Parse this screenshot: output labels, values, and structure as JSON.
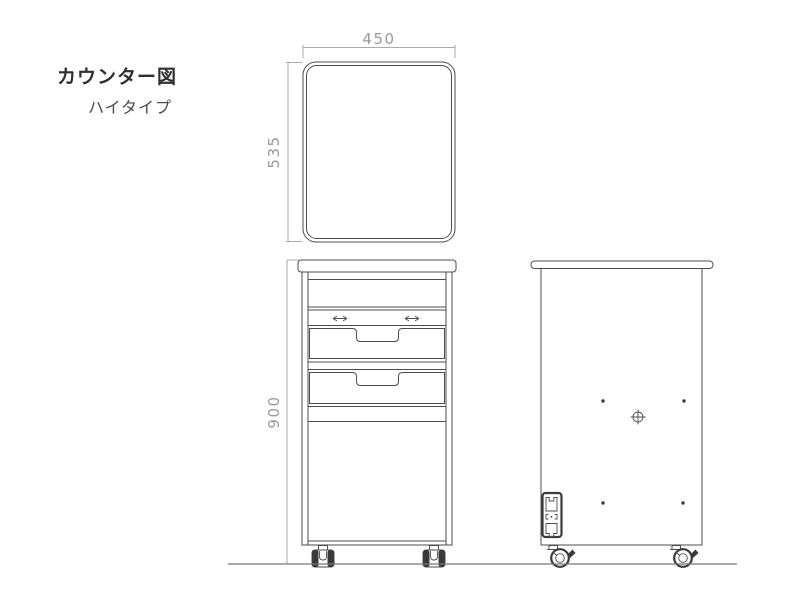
{
  "title": {
    "main": "カウンター図",
    "subtitle": "ハイタイプ"
  },
  "drawing": {
    "dimensions": {
      "top_width": "450",
      "top_depth": "535",
      "height": "900"
    },
    "views": {
      "top_view": "counter-top-plan",
      "front_view": "counter-front-elevation",
      "side_view": "counter-side-elevation"
    }
  },
  "colors": {
    "line": "#4d4d4d",
    "dark": "#3a3a3a",
    "dim": "#ababab",
    "dimtext": "#9a9a9a",
    "title": "#2f2f2f",
    "subtitle": "#4a4a4a",
    "ground": "#777777"
  }
}
